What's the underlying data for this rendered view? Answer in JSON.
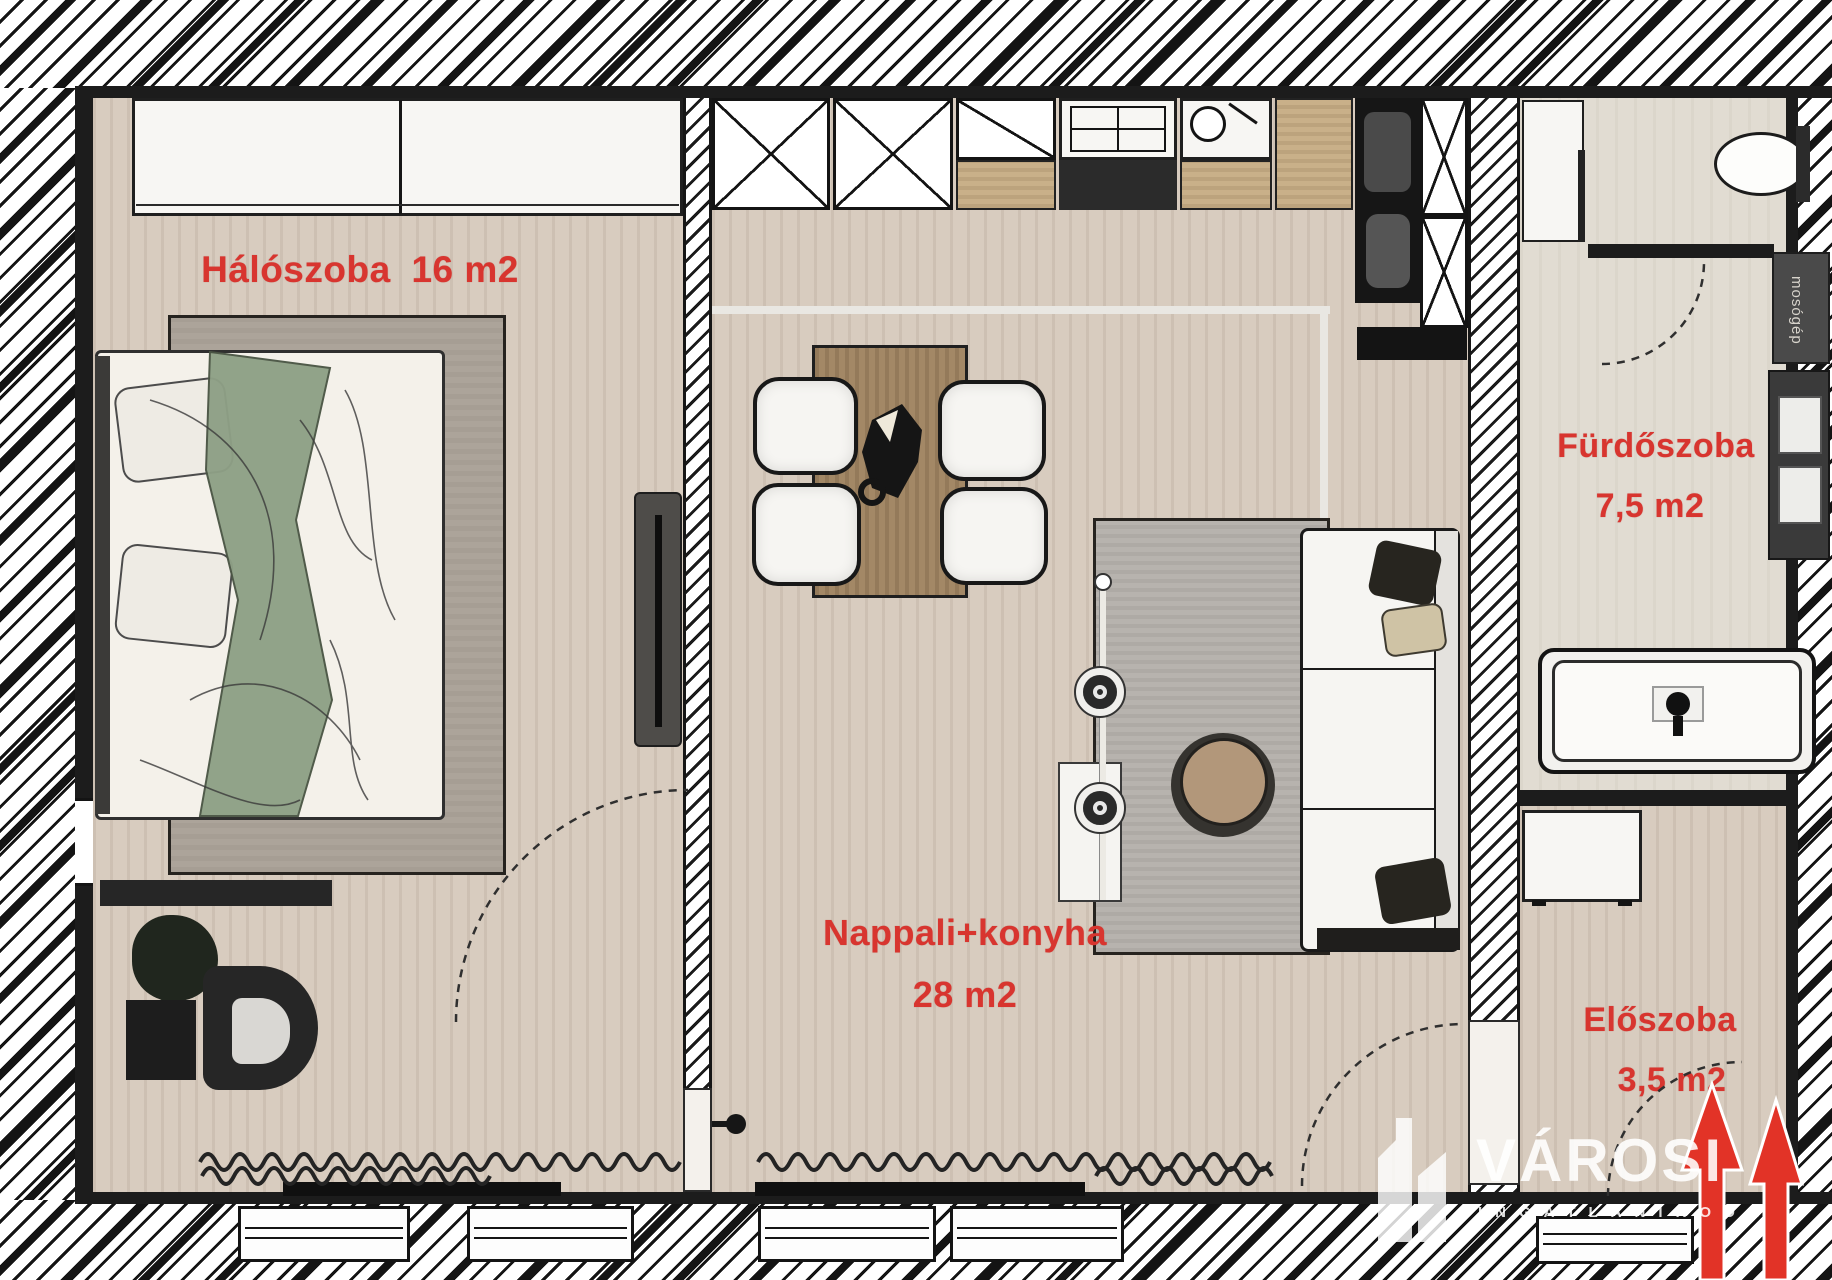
{
  "rooms": {
    "bedroom": {
      "name": "Hálószoba",
      "area": "16 m2"
    },
    "living": {
      "name": "Nappali+konyha",
      "area": "28 m2"
    },
    "bathroom": {
      "name": "Fürdőszoba",
      "area": "7,5 m2"
    },
    "hall": {
      "name": "Előszoba",
      "area": "3,5 m2"
    }
  },
  "appliances": {
    "washing_machine": "mosógép"
  },
  "watermark": {
    "brand": "VÁROSI",
    "subtitle": "INGATLANIRODA"
  },
  "colors": {
    "label_red": "#d8352f",
    "arrow_red": "#e23327",
    "wall_black": "#1c1c1c",
    "floor_wood": "#d8ccbf",
    "rug_gray": "#b7b3ae",
    "watermark_white": "rgba(255,255,255,0.88)"
  }
}
